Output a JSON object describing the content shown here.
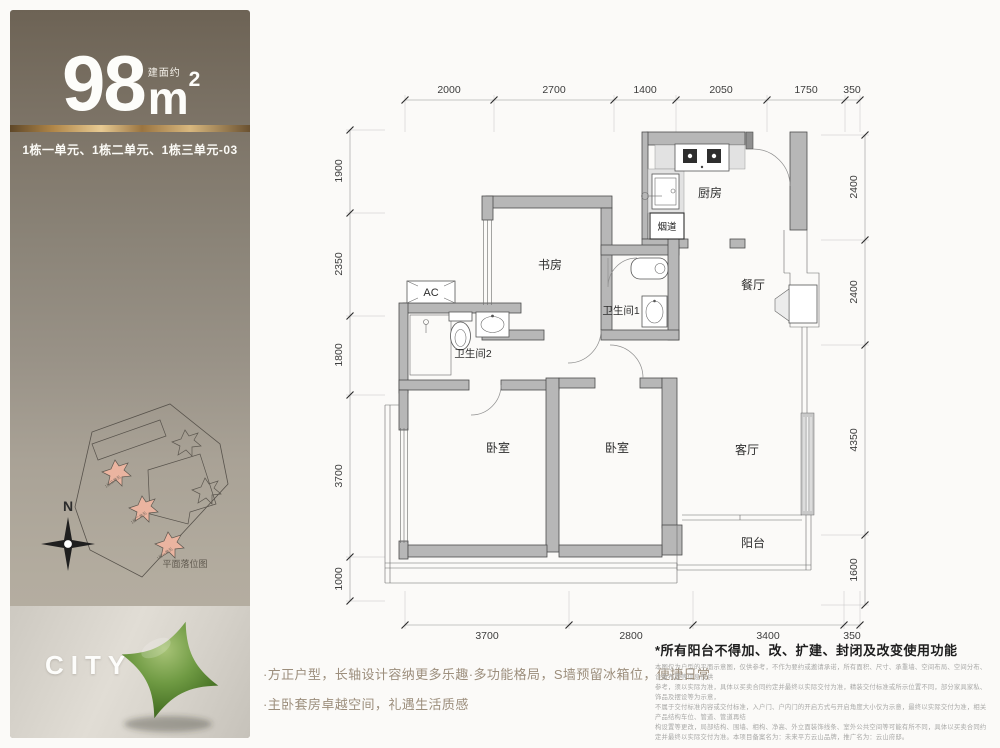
{
  "sidebar": {
    "area_note": "建面约",
    "area_value": "98",
    "area_unit": "m",
    "area_sup": "2",
    "unit_line": "1栋一单元、1栋二单元、1栋三单元-03",
    "site_plan": {
      "compass_label": "N",
      "caption": "平面落位图",
      "unit_labels": [
        "1栋三单元",
        "1栋二单元",
        "1栋一单元"
      ]
    },
    "brand": "CITY X"
  },
  "floorplan": {
    "labels": {
      "kitchen": "厨房",
      "flue": "烟道",
      "study": "书房",
      "bath1": "卫生间1",
      "bath2": "卫生间2",
      "dining": "餐厅",
      "bedroom": "卧室",
      "living": "客厅",
      "balcony": "阳台",
      "ac": "AC"
    },
    "dimensions": {
      "top": [
        "2000",
        "2700",
        "1400",
        "2050",
        "1750",
        "350"
      ],
      "left": [
        "1900",
        "2350",
        "1800",
        "3700",
        "1000"
      ],
      "right": [
        "2400",
        "2400",
        "4350",
        "1600"
      ],
      "bottom": [
        "3700",
        "2800",
        "3400",
        "350"
      ]
    }
  },
  "footer": {
    "features": [
      "·方正户型，长轴设计容纳更多乐趣·多功能格局，S墙预留冰箱位，便捷日常",
      "·主卧套房卓越空间，礼遇生活质感"
    ],
    "disclaimer_title": "*所有阳台不得加、改、扩建、封闭及改变使用功能",
    "disclaimer_lines": [
      "本图仅为户型的平面示意图，仅供参考，不作为要约或邀请承诺，所有面积、尺寸、承重墙、空间布局、空间分布、设备布置等信息仅供",
      "参考，须以实际为准，具体以买卖合同约定并最终以实际交付为准，精装交付标准或所示位置不同，部分家具家私、饰品及摆设等为示意，",
      "不属于交付标准内容或交付标准，入户门、户内门的开启方式与开启角度大小仅为示意，最终以实际交付为准，相关产品结构车位、管道、管道再结",
      "构设置等更改，局部结构、围墙、相构、净高、外立面装饰线条、室外公共空间等可能有所不同，具体以买卖合同约定并最终以实际交付为准。本项目备案名为：未来平方云山品牌，推广名为：云山府邸。"
    ]
  },
  "colors": {
    "gold": "#c9a063",
    "wall_gray": "#b7b7b7",
    "highlight_pink": "#eab4a0",
    "brand_green": "#5c8a38"
  }
}
